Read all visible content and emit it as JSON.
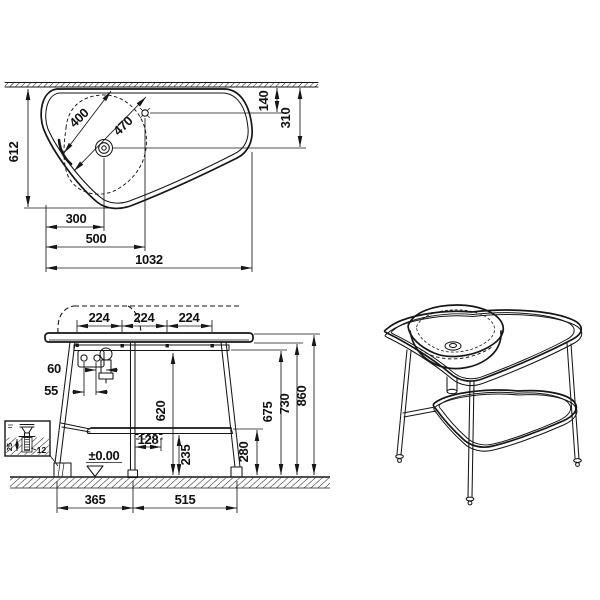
{
  "plan": {
    "depth": "612",
    "faucet_offset": "140",
    "drain_offset": "310",
    "basin_inner": "400",
    "basin_outer": "470",
    "drain_left": "300",
    "faucet_left": "500",
    "total_width": "1032"
  },
  "front": {
    "spacing_a": "224",
    "spacing_b": "224",
    "spacing_c": "224",
    "trap_offset": "60",
    "hole_spacing": "55",
    "clearance": "620",
    "bracket": "128",
    "shelf_front": "235",
    "shelf_height": "280",
    "rail_height": "675",
    "underside": "730",
    "total_height": "860",
    "span_left": "365",
    "span_right": "515",
    "level": "±0.00"
  },
  "detail": {
    "depth": "25",
    "offset": "12"
  }
}
